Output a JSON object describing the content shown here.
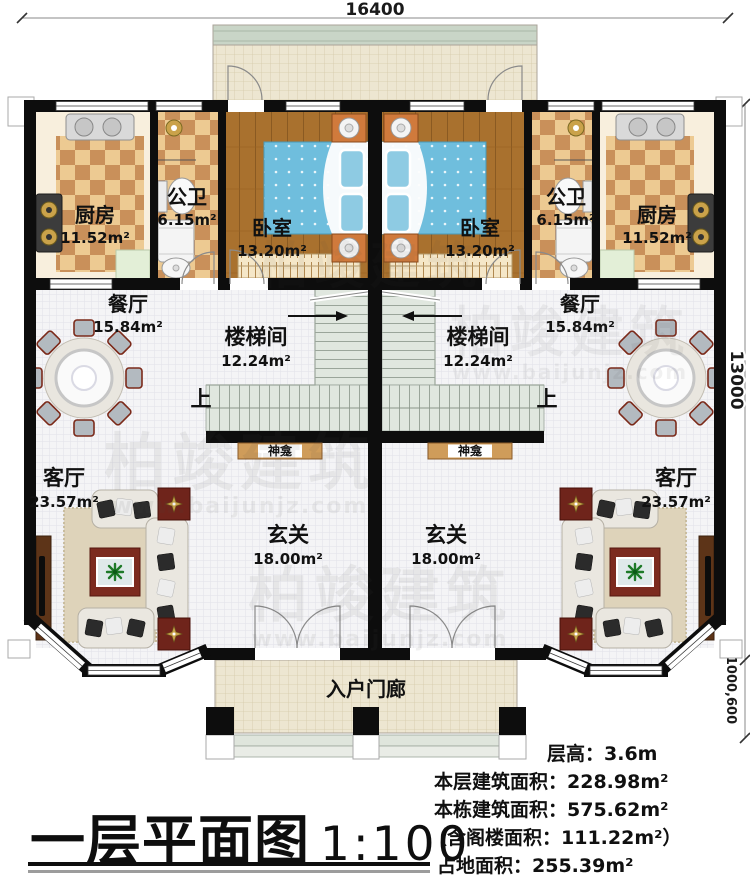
{
  "meta": {
    "doc_type": "residential-floor-plan",
    "floor": "1"
  },
  "dimensions": {
    "top_width": "16400",
    "right_height": "13000",
    "right_offsets": "1000,600"
  },
  "rooms": {
    "kitchen": {
      "name": "厨房",
      "area": "11.52m²"
    },
    "bathroom": {
      "name": "公卫",
      "area": "6.15m²"
    },
    "bedroom": {
      "name": "卧室",
      "area": "13.20m²"
    },
    "dining": {
      "name": "餐厅",
      "area": "15.84m²"
    },
    "stairwell": {
      "name": "楼梯间",
      "area": "12.24m²"
    },
    "living": {
      "name": "客厅",
      "area": "23.57m²"
    },
    "foyer": {
      "name": "玄关",
      "area": "18.00m²"
    }
  },
  "labels": {
    "shrine": "神龛",
    "up": "上",
    "porch": "入户门廊"
  },
  "title": {
    "text": "一层平面图",
    "scale": "1:100"
  },
  "info_lines": [
    "层高：3.6m",
    "本层建筑面积：228.98m²",
    "本栋建筑面积：575.62m²",
    "（含阁楼面积：111.22m²）",
    "占地面积：255.39m²"
  ],
  "watermark": {
    "brand": "柏竣建筑",
    "url": "www.baijunjz.com"
  },
  "colors": {
    "wall": "#0d0d0d",
    "checker_light": "#edca92",
    "checker_dark": "#c9905a",
    "wood_floor": "#a9712e",
    "bed_blue": "#6fbedd",
    "nightstand_orange": "#d07a3c",
    "stair_green": "#e0e7df",
    "shrine_wood": "#cf9c5a",
    "terrace_band": "#c9d5c7",
    "floor_tile": "#ede6d1",
    "sofa": "#eae7e0",
    "rug": "#ded3ba",
    "coffee_table": "#7c2b1f",
    "tv_cabinet": "#5d3418"
  }
}
